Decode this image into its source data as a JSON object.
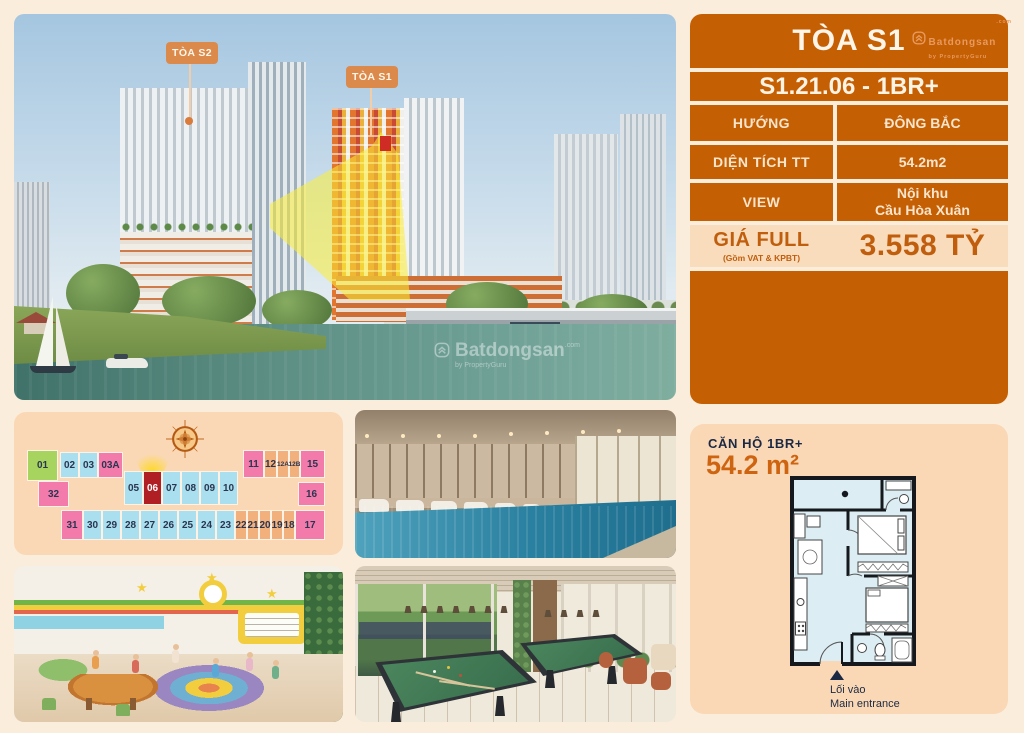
{
  "brand": {
    "name": "Batdongsan",
    "domain": ".com",
    "byline": "by PropertyGuru"
  },
  "photo": {
    "tower_labels": [
      {
        "label": "TÒA S2"
      },
      {
        "label": "TÒA S1"
      }
    ],
    "watermark": {
      "name": "Batdongsan",
      "domain": ".com",
      "byline": "by PropertyGuru"
    }
  },
  "info": {
    "title": "TÒA S1",
    "unit_code": "S1.21.06 - 1BR+",
    "rows": [
      {
        "label": "HƯỚNG",
        "value": "ĐÔNG BẮC"
      },
      {
        "label": "DIỆN TÍCH TT",
        "value": "54.2m2"
      },
      {
        "label": "VIEW",
        "value": "Nội khu\nCầu Hòa Xuân"
      }
    ],
    "price": {
      "label": "GIÁ FULL",
      "sublabel": "(Gồm VAT & KPBT)",
      "value": "3.558 TỶ"
    }
  },
  "floorplate": {
    "selected_unit": "06",
    "units": [
      {
        "label": "01",
        "color": "green",
        "x": 13,
        "y": 38,
        "w": 31,
        "h": 31
      },
      {
        "label": "02",
        "color": "blue",
        "x": 46,
        "y": 40,
        "w": 19,
        "h": 26
      },
      {
        "label": "03",
        "color": "blue",
        "x": 65,
        "y": 40,
        "w": 19,
        "h": 26
      },
      {
        "label": "03A",
        "color": "pink",
        "x": 84,
        "y": 40,
        "w": 25,
        "h": 26
      },
      {
        "label": "32",
        "color": "pink",
        "x": 24,
        "y": 69,
        "w": 31,
        "h": 26
      },
      {
        "label": "05",
        "color": "blue",
        "x": 110,
        "y": 59,
        "w": 19,
        "h": 34
      },
      {
        "label": "06",
        "color": "red",
        "x": 129,
        "y": 59,
        "w": 19,
        "h": 34
      },
      {
        "label": "07",
        "color": "blue",
        "x": 148,
        "y": 59,
        "w": 19,
        "h": 34
      },
      {
        "label": "08",
        "color": "blue",
        "x": 167,
        "y": 59,
        "w": 19,
        "h": 34
      },
      {
        "label": "09",
        "color": "blue",
        "x": 186,
        "y": 59,
        "w": 19,
        "h": 34
      },
      {
        "label": "10",
        "color": "blue",
        "x": 205,
        "y": 59,
        "w": 19,
        "h": 34
      },
      {
        "label": "11",
        "color": "pink",
        "x": 229,
        "y": 38,
        "w": 21,
        "h": 28
      },
      {
        "label": "12",
        "color": "orange",
        "x": 250,
        "y": 38,
        "w": 13,
        "h": 28
      },
      {
        "label": "12A",
        "color": "orange",
        "small": true,
        "x": 263,
        "y": 38,
        "w": 12,
        "h": 28
      },
      {
        "label": "12B",
        "color": "orange",
        "small": true,
        "x": 275,
        "y": 38,
        "w": 11,
        "h": 28
      },
      {
        "label": "15",
        "color": "pink",
        "x": 286,
        "y": 38,
        "w": 25,
        "h": 28
      },
      {
        "label": "16",
        "color": "pink",
        "x": 284,
        "y": 70,
        "w": 27,
        "h": 24
      },
      {
        "label": "31",
        "color": "pink",
        "x": 47,
        "y": 98,
        "w": 22,
        "h": 30
      },
      {
        "label": "30",
        "color": "blue",
        "x": 69,
        "y": 98,
        "w": 19,
        "h": 30
      },
      {
        "label": "29",
        "color": "blue",
        "x": 88,
        "y": 98,
        "w": 19,
        "h": 30
      },
      {
        "label": "28",
        "color": "blue",
        "x": 107,
        "y": 98,
        "w": 19,
        "h": 30
      },
      {
        "label": "27",
        "color": "blue",
        "x": 126,
        "y": 98,
        "w": 19,
        "h": 30
      },
      {
        "label": "26",
        "color": "blue",
        "x": 145,
        "y": 98,
        "w": 19,
        "h": 30
      },
      {
        "label": "25",
        "color": "blue",
        "x": 164,
        "y": 98,
        "w": 19,
        "h": 30
      },
      {
        "label": "24",
        "color": "blue",
        "x": 183,
        "y": 98,
        "w": 19,
        "h": 30
      },
      {
        "label": "23",
        "color": "blue",
        "x": 202,
        "y": 98,
        "w": 19,
        "h": 30
      },
      {
        "label": "22",
        "color": "orange",
        "x": 221,
        "y": 98,
        "w": 12,
        "h": 30
      },
      {
        "label": "21",
        "color": "orange",
        "x": 233,
        "y": 98,
        "w": 12,
        "h": 30
      },
      {
        "label": "20",
        "color": "orange",
        "x": 245,
        "y": 98,
        "w": 12,
        "h": 30
      },
      {
        "label": "19",
        "color": "orange",
        "x": 257,
        "y": 98,
        "w": 12,
        "h": 30
      },
      {
        "label": "18",
        "color": "orange",
        "x": 269,
        "y": 98,
        "w": 12,
        "h": 30
      },
      {
        "label": "17",
        "color": "pink",
        "x": 281,
        "y": 98,
        "w": 30,
        "h": 30
      }
    ]
  },
  "plan": {
    "apt_type": "CĂN HỘ 1BR+",
    "area": "54.2 m²",
    "entrance_vi": "Lối vào",
    "entrance_en": "Main entrance"
  },
  "colors": {
    "accent_orange": "#C55F04",
    "peach_panel": "#FAD8B5",
    "page_bg": "#FBEDDC",
    "navy_text": "#1B2944",
    "selected_unit_red": "#B01F24"
  }
}
